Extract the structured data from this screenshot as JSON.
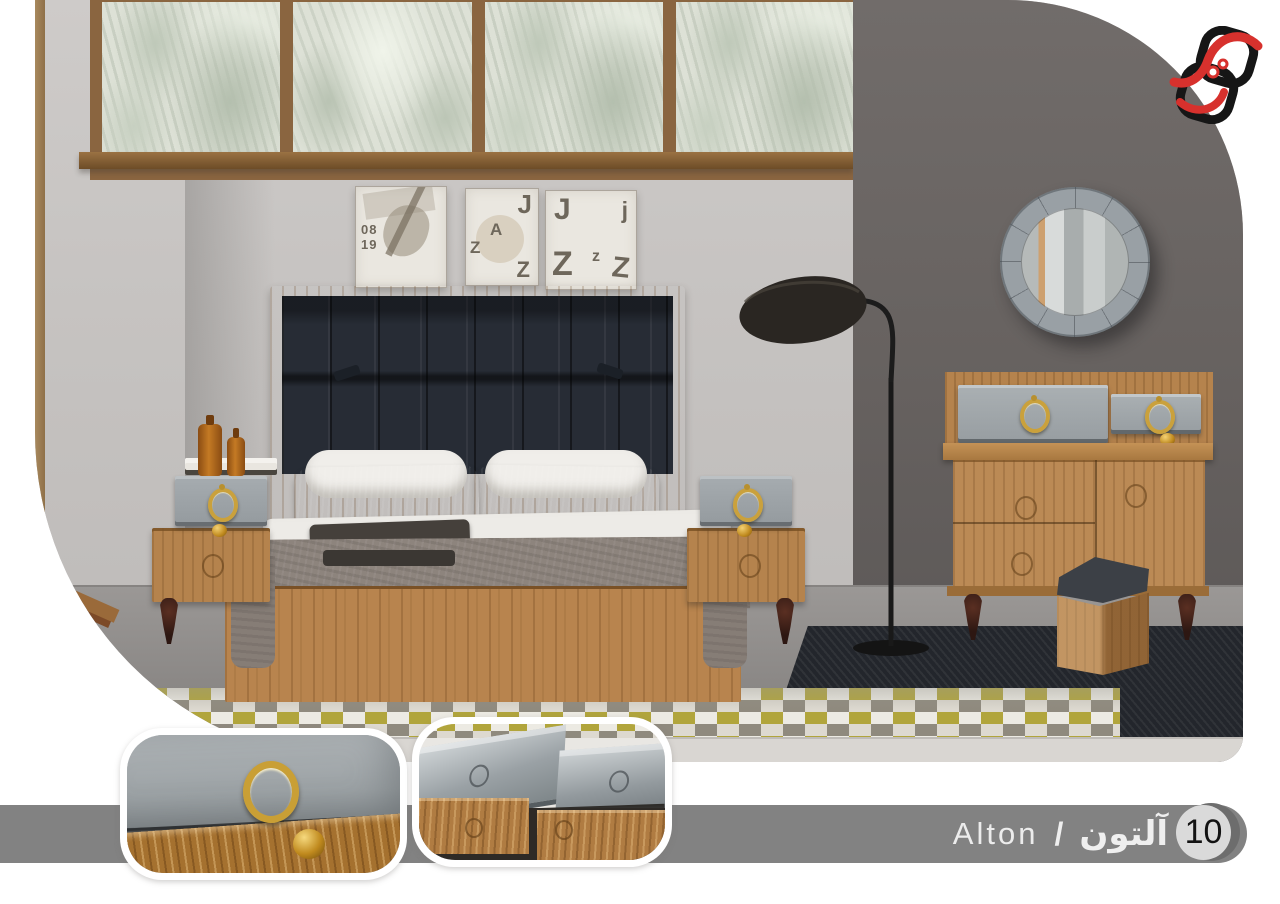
{
  "brand": {
    "logo_icon": "interlocking-rings-logo",
    "logo_black": "#161616",
    "logo_red": "#d7312d"
  },
  "footer": {
    "bar_color": "#828282",
    "badge_number": "10",
    "name_latin": "Alton",
    "separator": "/",
    "name_arabic": "آلتون"
  },
  "scene": {
    "light_wall_color": "#c6c3c1",
    "accent_wall_color": "#676260",
    "wood_color": "#b5834d",
    "headboard_color": "#272c35",
    "handle_gold_color": "#caa13c",
    "posters": [
      {
        "line1": "08",
        "line2": "19"
      },
      {
        "l1": "J",
        "l2": "A",
        "l3": "Z",
        "l4": "Z"
      },
      {
        "l1": "J",
        "l2": "j",
        "l3": "Z",
        "l4": "z",
        "l5": "Z"
      }
    ]
  }
}
